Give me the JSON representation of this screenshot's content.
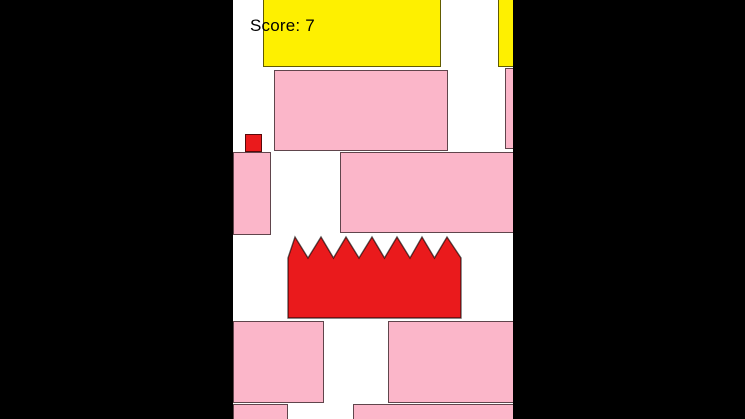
{
  "hud": {
    "score_label": "Score: 7",
    "score_value": 7
  },
  "palette": {
    "background": "#000000",
    "playfield": "#ffffff",
    "pink": "#fbb6c9",
    "red": "#ea1a1c",
    "yellow": "#fef000",
    "outline": "rgba(0,0,0,0.62)",
    "score_text": "#000000"
  },
  "scene": {
    "viewport": {
      "x": 233,
      "y": 0,
      "width": 280,
      "height": 419
    },
    "entities": [
      {
        "name": "yellow-block-top-left",
        "shape": "rect",
        "color": "yellow",
        "x": 30,
        "y": -8,
        "w": 178,
        "h": 75
      },
      {
        "name": "yellow-block-top-right",
        "shape": "rect",
        "color": "yellow",
        "x": 265,
        "y": -8,
        "w": 22,
        "h": 75
      },
      {
        "name": "pink-platform-upper",
        "shape": "rect",
        "color": "pink",
        "x": 41,
        "y": 70,
        "w": 174,
        "h": 81
      },
      {
        "name": "pink-strip-upper-right",
        "shape": "rect",
        "color": "pink",
        "x": 272,
        "y": 68,
        "w": 14,
        "h": 81
      },
      {
        "name": "pink-platform-mid-left",
        "shape": "rect",
        "color": "pink",
        "x": 0,
        "y": 152,
        "w": 38,
        "h": 83
      },
      {
        "name": "pink-platform-mid-right",
        "shape": "rect",
        "color": "pink",
        "x": 107,
        "y": 152,
        "w": 177,
        "h": 81
      },
      {
        "name": "player-square",
        "shape": "rect",
        "color": "red",
        "x": 12,
        "y": 134,
        "w": 17,
        "h": 18
      },
      {
        "name": "spike-obstacle",
        "shape": "spikes",
        "color": "red",
        "x": 55,
        "y": 237,
        "w": 173,
        "h": 81,
        "points": "0,81 0,21 7,0 20,21 33,0 45.5,21 58,0 71,21 84,0 96.5,21 109,0 122,21 134,0 146.5,21 159,0 173,21 173,81"
      },
      {
        "name": "pink-platform-lower-left",
        "shape": "rect",
        "color": "pink",
        "x": 0,
        "y": 321,
        "w": 91,
        "h": 82
      },
      {
        "name": "pink-platform-lower-right",
        "shape": "rect",
        "color": "pink",
        "x": 155,
        "y": 321,
        "w": 131,
        "h": 82
      },
      {
        "name": "pink-strip-bottom-left",
        "shape": "rect",
        "color": "pink",
        "x": 0,
        "y": 404,
        "w": 55,
        "h": 18
      },
      {
        "name": "pink-strip-bottom-right",
        "shape": "rect",
        "color": "pink",
        "x": 120,
        "y": 404,
        "w": 166,
        "h": 18
      }
    ]
  }
}
